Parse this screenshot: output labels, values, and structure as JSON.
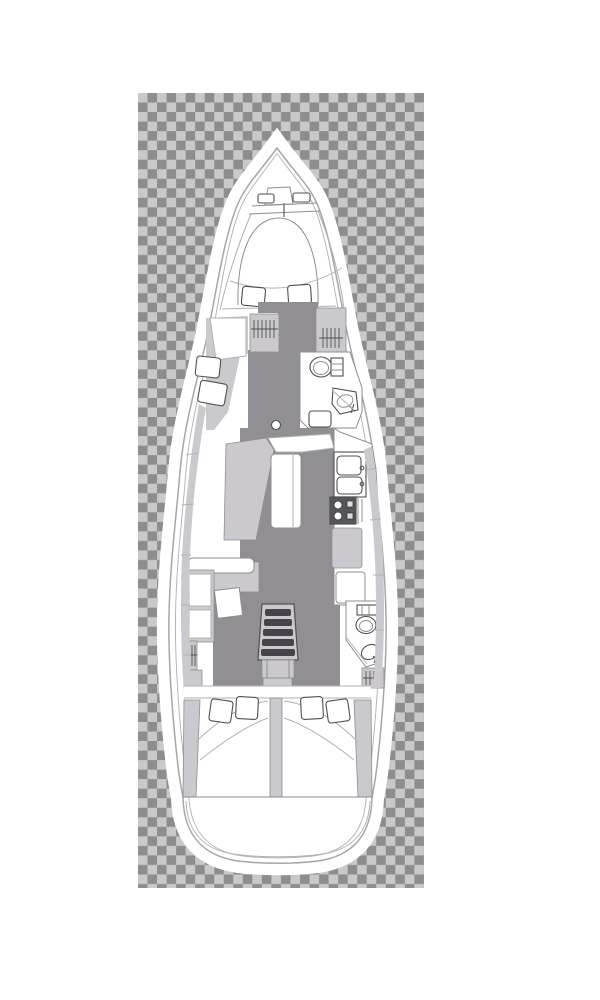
{
  "image_type": "sailboat-interior-deck-plan",
  "colors": {
    "checker-dark": "#8d8d8d",
    "checker-light": "#c9c9c9",
    "hull-white": "#ffffff",
    "furniture": "#cbc9cd",
    "furniture-mid": "#bdbbbf",
    "walkway": "#918f93",
    "stove-dark": "#57555b",
    "steps-dark": "#46444a",
    "outline-light": "#b2b2b2",
    "outline-mid": "#8e8e8e",
    "outline-dark": "#4f4f4f",
    "hull-stroke": "#a6a6a6"
  },
  "checkerboard": {
    "x": 138,
    "y": 93,
    "width": 286,
    "height": 795,
    "cell_px": 9.53
  },
  "boat": {
    "orientation": "bow-up",
    "features": [
      "bow-anchor-locker",
      "windlass-fittings",
      "foredeck-lines",
      "v-berth-bed",
      "v-berth-pillows",
      "owner-cabin-seats",
      "port-wardrobe",
      "starboard-wardrobe",
      "forward-head-toilet",
      "forward-head-sink",
      "forward-head-shower",
      "forward-head-door",
      "salon-l-settee",
      "salon-table",
      "salon-cup-holder",
      "salon-bench",
      "port-cabinets",
      "nav-desk",
      "port-hanging-locker",
      "galley-double-sink",
      "galley-stove",
      "galley-fridge",
      "galley-counter",
      "companionway-steps",
      "aft-head-toilet",
      "aft-head-sink",
      "aft-head-door",
      "starboard-hanging-locker",
      "port-aft-cabin-bed",
      "starboard-aft-cabin-bed",
      "aft-cabin-pillows",
      "cabin-divider",
      "transom-swim-platform"
    ]
  }
}
